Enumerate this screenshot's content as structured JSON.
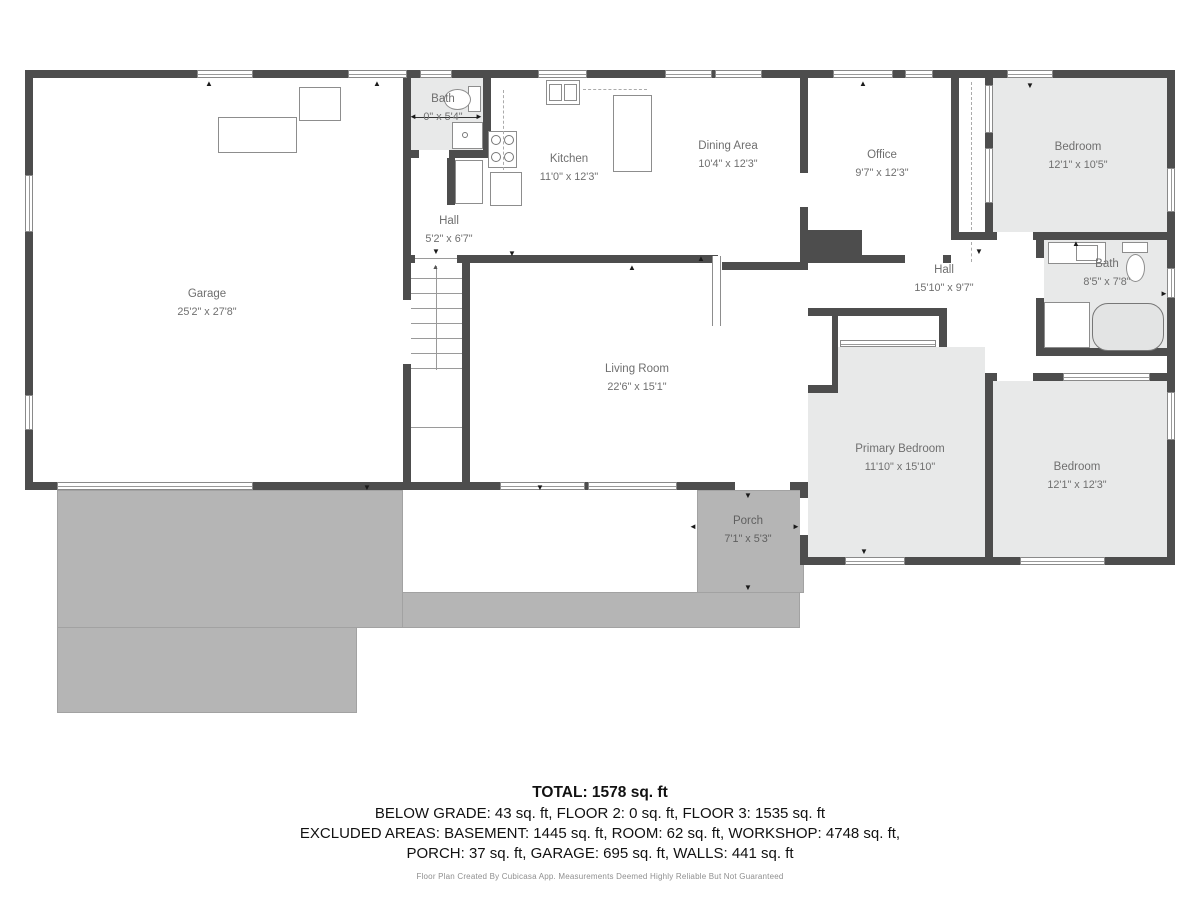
{
  "rooms": [
    {
      "name": "Garage",
      "dims": "25'2\" x 27'8\""
    },
    {
      "name": "Bath",
      "dims": "0\" x 5'4\""
    },
    {
      "name": "Hall",
      "dims": "5'2\" x 6'7\""
    },
    {
      "name": "Kitchen",
      "dims": "11'0\" x 12'3\""
    },
    {
      "name": "Dining Area",
      "dims": "10'4\" x 12'3\""
    },
    {
      "name": "Office",
      "dims": "9'7\" x 12'3\""
    },
    {
      "name": "Bedroom",
      "dims": "12'1\" x 10'5\""
    },
    {
      "name": "Hall",
      "dims": "15'10\" x 9'7\""
    },
    {
      "name": "Bath",
      "dims": "8'5\" x 7'8\""
    },
    {
      "name": "Living Room",
      "dims": "22'6\" x 15'1\""
    },
    {
      "name": "Primary Bedroom",
      "dims": "11'10\" x 15'10\""
    },
    {
      "name": "Bedroom",
      "dims": "12'1\" x 12'3\""
    },
    {
      "name": "Porch",
      "dims": "7'1\" x 5'3\""
    }
  ],
  "summary": {
    "total": "TOTAL: 1578 sq. ft",
    "line1": "BELOW GRADE: 43 sq. ft, FLOOR 2: 0 sq. ft, FLOOR 3: 1535 sq. ft",
    "line2": "EXCLUDED AREAS: BASEMENT: 1445 sq. ft, ROOM: 62 sq. ft, WORKSHOP: 4748 sq. ft,",
    "line3": "PORCH: 37 sq. ft, GARAGE: 695 sq. ft, WALLS: 441 sq. ft"
  },
  "credit": "Floor Plan Created By Cubicasa App. Measurements Deemed Highly Reliable But Not Guaranteed",
  "colors": {
    "wall": "#4d4d4d",
    "room_fill": "#e8e9e9",
    "paving": "#b5b5b5",
    "label_text": "#6f6f6f"
  }
}
